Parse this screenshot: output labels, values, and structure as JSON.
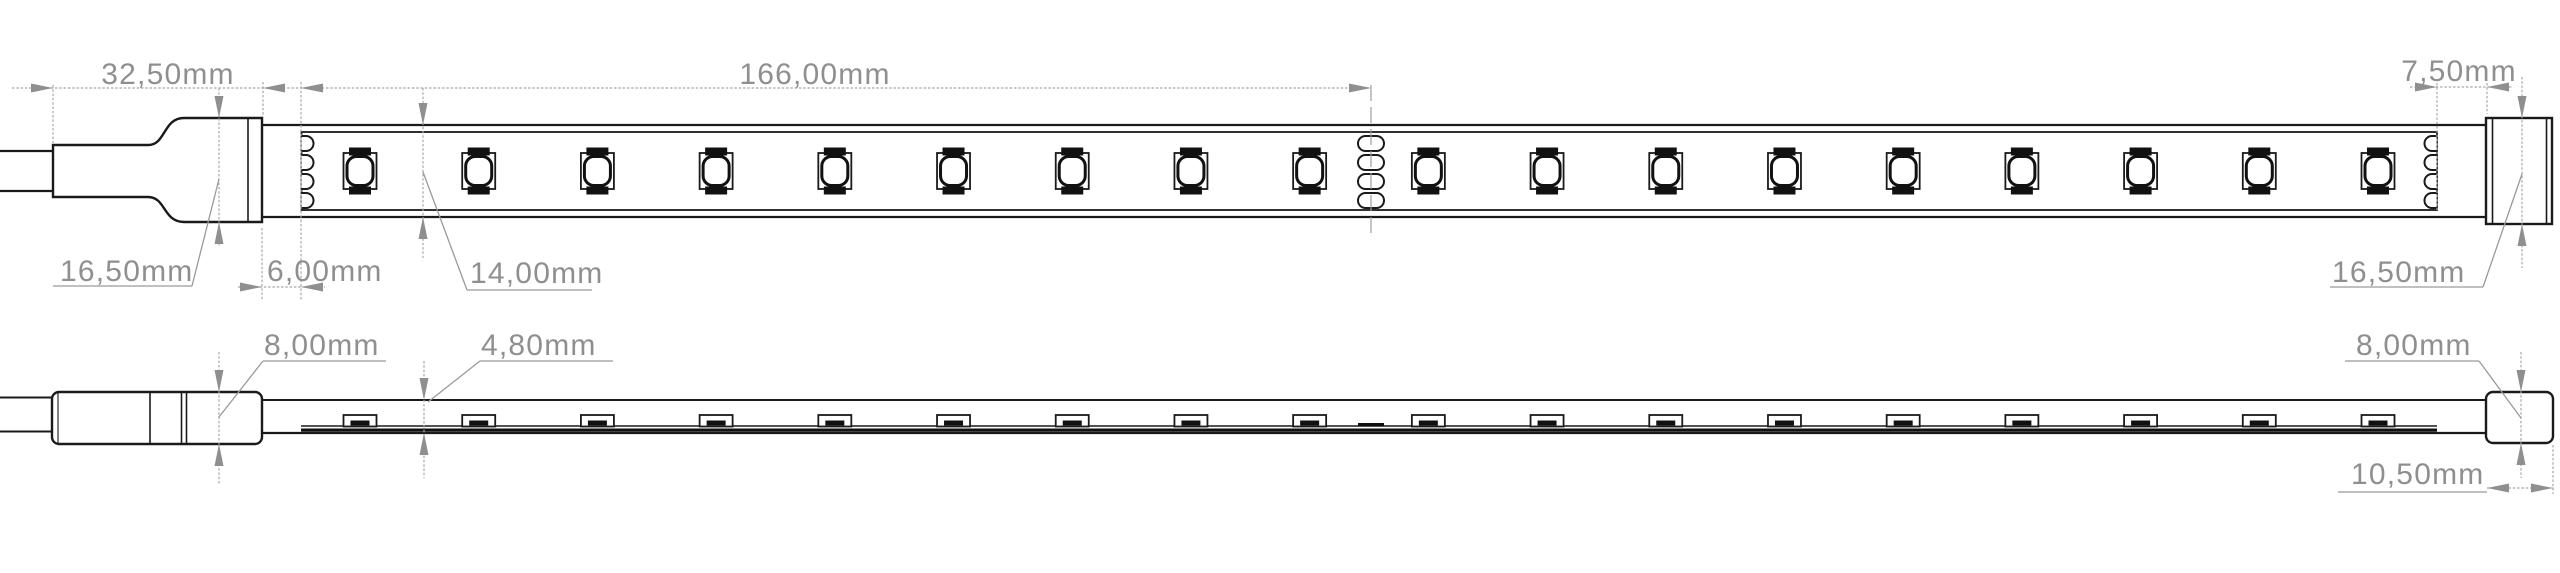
{
  "drawing": {
    "title": "led-strip-dimension-drawing",
    "top_view": {
      "dimensions": {
        "connector_length": "32,50mm",
        "segment_length": "166,00mm",
        "end_offset": "7,50mm",
        "connector_width": "16,50mm",
        "lead_in": "6,00mm",
        "strip_width": "14,00mm",
        "end_cap_width": "16,50mm"
      },
      "led_count": 18,
      "solder_pad_count": 4
    },
    "side_view": {
      "dimensions": {
        "connector_thickness": "8,00mm",
        "strip_thickness": "4,80mm",
        "end_cap_thickness": "8,00mm",
        "end_cap_length": "10,50mm"
      },
      "led_count": 18
    },
    "colors": {
      "outline": "#1a1a1a",
      "dimension_line": "#a8a8a8",
      "dimension_text": "#8f8f8f",
      "background": "#ffffff"
    }
  }
}
